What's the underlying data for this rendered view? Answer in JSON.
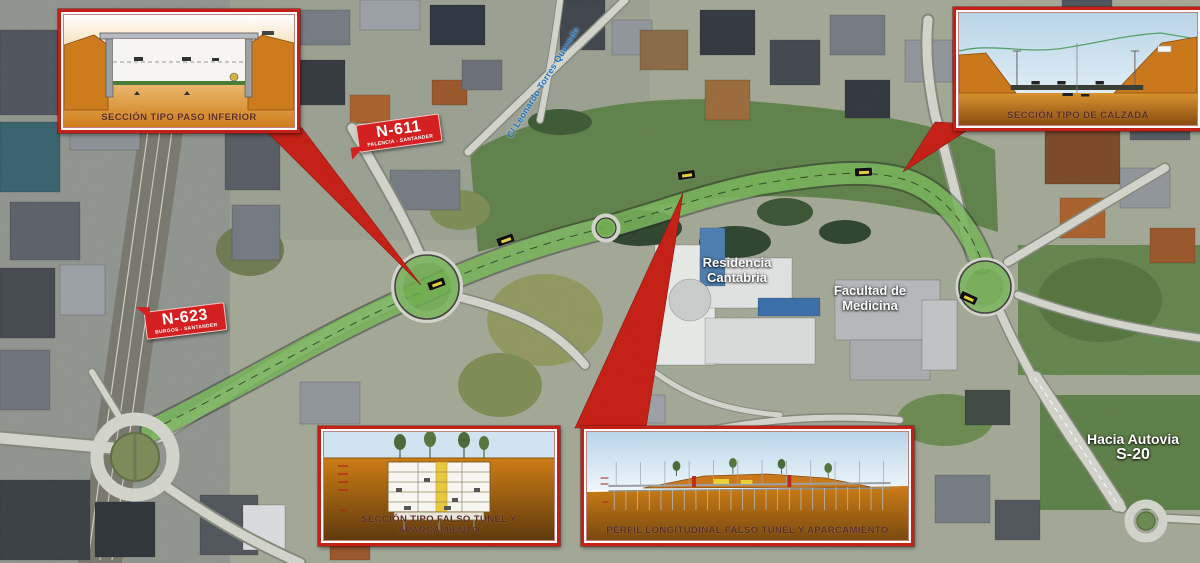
{
  "callouts": {
    "paso_inferior": {
      "caption": "SECCIÓN TIPO PASO INFERIOR"
    },
    "calzada": {
      "caption": "SECCIÓN TIPO DE CALZADA"
    },
    "falso_tunel": {
      "caption": "SECCIÓN TIPO FALSO TUNEL Y APARCAMIENTO"
    },
    "perfil": {
      "caption": "PERFIL LONGITUDINAL FALSO TUNEL Y APARCAMIENTO"
    }
  },
  "road_badges": {
    "n611": {
      "code": "N-611",
      "subtitle": "PALENCIA - SANTANDER"
    },
    "n623": {
      "code": "N-623",
      "subtitle": "BURGOS - SANTANDER"
    }
  },
  "place_labels": {
    "residencia": {
      "line1": "Residencia",
      "line2": "Cantabria"
    },
    "facultad": {
      "line1": "Facultad de",
      "line2": "Medicina"
    },
    "autovia": {
      "line1": "Hacia Autovia",
      "line2": "S-20"
    }
  },
  "street_label": {
    "text": "C/ Leonardo Torres Quevedo"
  },
  "colors": {
    "callout_red": "#c32017",
    "earth_orange": "#cf7d1a",
    "corridor_green": "#7fc25f",
    "street_blue": "#1e73be"
  }
}
